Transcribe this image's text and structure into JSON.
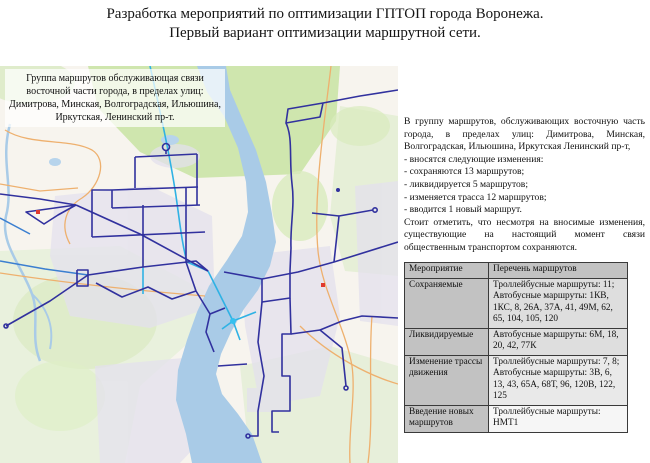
{
  "title": {
    "line1": "Разработка мероприятий по оптимизации ГПТОП города Воронежа.",
    "line2": "Первый вариант оптимизации маршрутной сети."
  },
  "map": {
    "overlay_text": "Группа маршрутов обслуживающая связи восточной части города, в пределах улиц: Димитрова, Минская, Волгоградская, Ильюшина, Иркутская, Ленинский пр-т."
  },
  "info_panel": {
    "intro": "В группу маршрутов, обслуживающих восточную часть города, в пределах улиц: Димитрова, Минская, Волгоградская, Ильюшина, Иркутская Ленинский пр-т,",
    "bullets": [
      "- вносятся следующие изменения:",
      "- сохраняются 13 маршрутов;",
      "- ликвидируется 5 маршрутов;",
      "- изменяется трасса 12 маршрутов;",
      "- вводится 1 новый маршрут."
    ],
    "note": "Стоит отметить, что несмотря на вносимые изменения, существующие на настоящий момент связи общественным транспортом сохраняются."
  },
  "table": {
    "header": [
      "Мероприятие",
      "Перечень маршрутов"
    ],
    "rows": [
      {
        "measure": "Сохраняемые",
        "routes": "Троллейбусные маршруты: 11;\nАвтобусные маршруты: 1КВ, 1КС, 8, 26А, 37А, 41, 49М, 62, 65, 104, 105, 120"
      },
      {
        "measure": "Ликвидируемые",
        "routes": "Автобусные маршруты: 6М, 18, 20, 42, 77К"
      },
      {
        "measure": "Изменение трассы движения",
        "routes": "Троллейбусные маршруты: 7, 8;\nАвтобусные маршруты: 3В, 6, 13, 43, 65А, 68Т, 96, 120В, 122, 125"
      },
      {
        "measure": "Введение новых маршрутов",
        "routes": "Троллейбусные маршруты: НМТ1"
      }
    ]
  },
  "colors": {
    "route_trolleybus_navy": "#31319e",
    "route_bus_cyan": "#2fb2e4",
    "route_blue": "#3b7fd0",
    "river_blue": "#a9cbe7",
    "forest_green": "#cfe6ae",
    "urban_lavender": "#e4e1ed",
    "road_orange": "#eeb06e",
    "map_background": "#f7f4ee",
    "table_header_gray": "#c2c2c2"
  }
}
